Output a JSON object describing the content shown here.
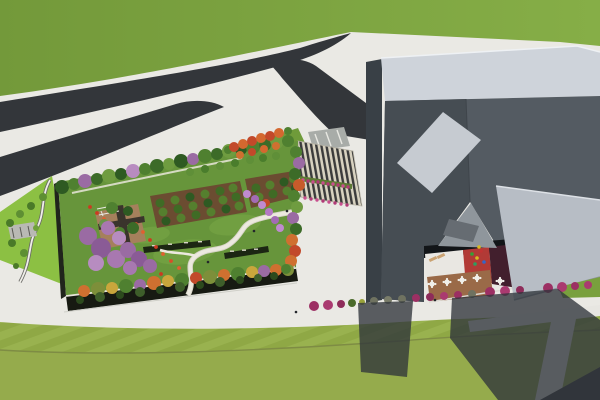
{
  "scene": {
    "alt": "Aerial 3D architectural render: rooftop-garden building and angular gray museum beside forked roads and lawns"
  },
  "palette": {
    "sidewalk": "#eae9e4",
    "grass_a": "#73993a",
    "grass_b": "#86ae47",
    "road": "#33363a",
    "crosswalk": "#a8aca8",
    "park_strip": "#8cc043",
    "pergola_gray": "#b9b9b4",
    "lawn_stripe_a": "#8fa845",
    "lawn_stripe_b": "#99b24f",
    "lawn_lower": "#95ab4c",
    "asphalt": "#37393c",
    "path_pale": "#e7e6e1",
    "garden_lawn": "#67953b",
    "lawn_patch": "#7aa846",
    "bed_brown": "#6b4c31",
    "hedge_dark": "#1c2613",
    "deck_tan": "#a5805c",
    "deck_dark": "#3a342c",
    "facade_dark": "#171a12",
    "facade_side": "#20241c",
    "berm_green": "#6f9b3a",
    "steps_brown": "#7a4a30",
    "canopy_dark": "#202327",
    "plaza_stripe_dark": "#3b3b3b",
    "plaza_stripe_cream": "#d8d2c0",
    "flower_strip_green": "#5c7a33",
    "rim_light": "#ced3da",
    "left_face": "#394046",
    "roof_dark_left": "#464d53",
    "roof_dark_right": "#545b62",
    "skylight_light": "#c6cbd1",
    "underside_face": "#8f969c",
    "skylight_mid": "#666c72",
    "wing_light": "#b7bdc5",
    "court_gap": "#121518",
    "court_white": "#e9e7e2",
    "court_red": "#b23a36",
    "court_maroon": "#421f2d",
    "court_brown": "#9a6a48",
    "table_white": "#f0efe9",
    "lounger_tan": "#caa272",
    "green_strip": "#79a03d",
    "shadow": "#2f353b"
  },
  "trees": {
    "top_row": [
      [
        62,
        187,
        7,
        "#2e5a22"
      ],
      [
        74,
        184,
        6,
        "#4f8030"
      ],
      [
        85,
        181,
        7,
        "#9a6ba3"
      ],
      [
        97,
        179,
        6,
        "#3c6b28"
      ],
      [
        109,
        176,
        7,
        "#6f9c40"
      ],
      [
        121,
        174,
        6,
        "#2e5a22"
      ],
      [
        133,
        171,
        7,
        "#b88cc0"
      ],
      [
        145,
        169,
        6,
        "#4f8030"
      ],
      [
        157,
        166,
        7,
        "#3c6b28"
      ],
      [
        169,
        164,
        6,
        "#6f9c40"
      ],
      [
        181,
        161,
        7,
        "#2e5a22"
      ],
      [
        193,
        159,
        6,
        "#9a6ba3"
      ],
      [
        205,
        156,
        7,
        "#4f8030"
      ],
      [
        217,
        154,
        6,
        "#3c6b28"
      ],
      [
        229,
        151,
        7,
        "#6f9c40"
      ],
      [
        241,
        149,
        6,
        "#2e5a22"
      ],
      [
        253,
        147,
        7,
        "#4f8030"
      ],
      [
        265,
        145,
        6,
        "#3c6b28"
      ],
      [
        277,
        143,
        6,
        "#6f9c40"
      ],
      [
        288,
        141,
        6,
        "#4f8030"
      ]
    ],
    "street_row": [
      [
        190,
        172,
        4,
        "#5f8f38"
      ],
      [
        205,
        169,
        4,
        "#4a7d2c"
      ],
      [
        220,
        166,
        4,
        "#5f8f38"
      ],
      [
        235,
        163,
        4,
        "#4a7d2c"
      ],
      [
        250,
        160,
        4,
        "#5f8f38"
      ],
      [
        263,
        158,
        4,
        "#4a7d2c"
      ],
      [
        276,
        156,
        4,
        "#5f8f38"
      ]
    ],
    "right_col": [
      [
        296,
        152,
        6,
        "#4f8030"
      ],
      [
        299,
        163,
        6,
        "#9a6ba3"
      ],
      [
        295,
        174,
        6,
        "#3c6b28"
      ],
      [
        299,
        185,
        6,
        "#c75b2b"
      ],
      [
        294,
        196,
        6,
        "#4f8030"
      ],
      [
        297,
        207,
        6,
        "#6f9c40"
      ],
      [
        293,
        218,
        6,
        "#9a6ba3"
      ],
      [
        296,
        229,
        6,
        "#3c6b28"
      ],
      [
        292,
        240,
        6,
        "#cf7030"
      ],
      [
        295,
        251,
        6,
        "#c2492a"
      ],
      [
        291,
        261,
        6,
        "#cf7030"
      ],
      [
        288,
        270,
        6,
        "#7d8f3a"
      ]
    ],
    "bottom_row": [
      [
        84,
        291,
        6,
        "#cf7030"
      ],
      [
        98,
        289,
        7,
        "#7d8f3a"
      ],
      [
        112,
        288,
        6,
        "#c9a63c"
      ],
      [
        126,
        286,
        7,
        "#4f8030"
      ],
      [
        140,
        285,
        6,
        "#9a6ba3"
      ],
      [
        154,
        283,
        7,
        "#cf7030"
      ],
      [
        168,
        281,
        6,
        "#c9a63c"
      ],
      [
        182,
        280,
        7,
        "#4f8030"
      ],
      [
        196,
        278,
        6,
        "#c2492a"
      ],
      [
        210,
        277,
        7,
        "#7d8f3a"
      ],
      [
        224,
        275,
        6,
        "#cf7030"
      ],
      [
        238,
        274,
        7,
        "#4f8030"
      ],
      [
        252,
        272,
        6,
        "#c9a63c"
      ],
      [
        264,
        271,
        6,
        "#9a6ba3"
      ],
      [
        276,
        270,
        6,
        "#cf7030"
      ],
      [
        286,
        269,
        5,
        "#4f8030"
      ]
    ],
    "purple_cluster": [
      [
        88,
        236,
        9,
        "#9a6ba3"
      ],
      [
        101,
        248,
        10,
        "#8a5b96"
      ],
      [
        116,
        259,
        9,
        "#a878b0"
      ],
      [
        96,
        263,
        8,
        "#b78cc0"
      ],
      [
        128,
        250,
        8,
        "#9a6ba3"
      ],
      [
        139,
        259,
        8,
        "#8a5b96"
      ],
      [
        119,
        238,
        7,
        "#b78cc0"
      ],
      [
        108,
        228,
        7,
        "#a878b0"
      ],
      [
        150,
        266,
        7,
        "#9a6ba3"
      ],
      [
        130,
        268,
        7,
        "#a878b0"
      ]
    ],
    "blossom_row": [
      [
        247,
        194,
        4,
        "#c08ad0"
      ],
      [
        255,
        199,
        4,
        "#a36bb5"
      ],
      [
        262,
        205,
        4,
        "#c08ad0"
      ],
      [
        269,
        212,
        4,
        "#b478c4"
      ],
      [
        275,
        220,
        4,
        "#a36bb5"
      ],
      [
        280,
        228,
        4,
        "#c08ad0"
      ]
    ],
    "orchard_a": [
      [
        160,
        203,
        4.5,
        "#3f6b25"
      ],
      [
        175,
        200,
        4.5,
        "#557f2e"
      ],
      [
        190,
        197,
        4.5,
        "#2e5a22"
      ],
      [
        205,
        194,
        4.5,
        "#557f2e"
      ],
      [
        220,
        191,
        4.5,
        "#3f6b25"
      ],
      [
        233,
        188,
        4.5,
        "#557f2e"
      ],
      [
        163,
        212,
        4.5,
        "#557f2e"
      ],
      [
        178,
        209,
        4.5,
        "#3f6b25"
      ],
      [
        193,
        206,
        4.5,
        "#557f2e"
      ],
      [
        208,
        203,
        4.5,
        "#2e5a22"
      ],
      [
        223,
        200,
        4.5,
        "#557f2e"
      ],
      [
        236,
        197,
        4.5,
        "#3f6b25"
      ],
      [
        166,
        221,
        4.5,
        "#2e5a22"
      ],
      [
        181,
        218,
        4.5,
        "#557f2e"
      ],
      [
        196,
        215,
        4.5,
        "#3f6b25"
      ],
      [
        211,
        212,
        4.5,
        "#557f2e"
      ],
      [
        226,
        209,
        4.5,
        "#2e5a22"
      ],
      [
        239,
        206,
        4.5,
        "#557f2e"
      ]
    ],
    "orchard_b": [
      [
        256,
        188,
        4.5,
        "#3f6b25"
      ],
      [
        270,
        185,
        4.5,
        "#557f2e"
      ],
      [
        284,
        182,
        4.5,
        "#2e5a22"
      ],
      [
        293,
        179,
        4,
        "#557f2e"
      ],
      [
        259,
        197,
        4.5,
        "#557f2e"
      ],
      [
        273,
        194,
        4.5,
        "#3f6b25"
      ],
      [
        287,
        191,
        4.5,
        "#557f2e"
      ],
      [
        295,
        188,
        4,
        "#2e5a22"
      ],
      [
        266,
        203,
        4,
        "#c2492a"
      ]
    ],
    "deck_trees": [
      [
        112,
        208,
        6,
        "#4f8030"
      ],
      [
        128,
        211,
        5,
        "#2e5a22"
      ],
      [
        104,
        224,
        5,
        "#6a944a"
      ],
      [
        133,
        228,
        6,
        "#3c6b28"
      ],
      [
        120,
        232,
        5,
        "#4f8030"
      ]
    ],
    "berm_trees": [
      [
        228,
        150,
        4,
        "#4f8030"
      ],
      [
        234,
        147,
        5,
        "#c2492a"
      ],
      [
        243,
        144,
        5,
        "#d4682f"
      ],
      [
        252,
        141,
        5,
        "#c2492a"
      ],
      [
        261,
        138,
        5,
        "#d4682f"
      ],
      [
        270,
        136,
        5,
        "#c2492a"
      ],
      [
        279,
        133,
        5,
        "#d4682f"
      ],
      [
        288,
        131,
        4,
        "#4f8030"
      ],
      [
        240,
        155,
        4,
        "#cf7030"
      ],
      [
        252,
        152,
        4,
        "#c2492a"
      ],
      [
        264,
        149,
        4,
        "#d4682f"
      ],
      [
        276,
        146,
        4,
        "#cf7030"
      ]
    ],
    "park_bushes": [
      [
        10,
        223,
        4,
        "#4a7a28"
      ],
      [
        20,
        214,
        4,
        "#5e8f33"
      ],
      [
        31,
        206,
        4,
        "#4a7a28"
      ],
      [
        43,
        197,
        4,
        "#5e8f33"
      ],
      [
        12,
        243,
        4,
        "#4a7a28"
      ],
      [
        24,
        253,
        4,
        "#5e8f33"
      ],
      [
        16,
        266,
        3,
        "#4a7a28"
      ],
      [
        36,
        228,
        3,
        "#6fa03a"
      ]
    ],
    "facade_bushes": [
      [
        80,
        300,
        4,
        "#2c4a1d"
      ],
      [
        100,
        297,
        5,
        "#3e5e2a"
      ],
      [
        120,
        295,
        4,
        "#2c4a1d"
      ],
      [
        140,
        292,
        5,
        "#3e5e2a"
      ],
      [
        160,
        290,
        4,
        "#2c4a1d"
      ],
      [
        180,
        287,
        5,
        "#3e5e2a"
      ],
      [
        200,
        285,
        4,
        "#2c4a1d"
      ],
      [
        220,
        282,
        5,
        "#3e5e2a"
      ],
      [
        240,
        280,
        4,
        "#2c4a1d"
      ],
      [
        258,
        278,
        4,
        "#3e5e2a"
      ],
      [
        274,
        276,
        4,
        "#2c4a1d"
      ]
    ],
    "shrub_row": [
      [
        314,
        306,
        5,
        "#9c2f63"
      ],
      [
        328,
        305,
        5,
        "#aa3a70"
      ],
      [
        341,
        304,
        4,
        "#8e2c5a"
      ],
      [
        352,
        303,
        4,
        "#4a6a2a"
      ],
      [
        362,
        302,
        3,
        "#9aa33a"
      ],
      [
        374,
        301,
        4,
        "#6f7260"
      ],
      [
        388,
        300,
        4,
        "#7a7d6a"
      ],
      [
        402,
        299,
        4,
        "#6f7260"
      ],
      [
        416,
        298,
        4,
        "#9c2f63"
      ],
      [
        430,
        297,
        4,
        "#8e2c5a"
      ],
      [
        444,
        296,
        4,
        "#aa3a70"
      ],
      [
        458,
        295,
        4,
        "#9c2f63"
      ],
      [
        472,
        294,
        4,
        "#6f7260"
      ],
      [
        490,
        292,
        5,
        "#9c2f63"
      ],
      [
        505,
        291,
        5,
        "#aa3a70"
      ],
      [
        520,
        290,
        4,
        "#8e2c5a"
      ],
      [
        548,
        288,
        5,
        "#9c2f63"
      ],
      [
        562,
        287,
        5,
        "#aa3a70"
      ],
      [
        575,
        286,
        4,
        "#9c2f63"
      ],
      [
        588,
        285,
        4,
        "#aa3a70"
      ]
    ]
  },
  "flowers": {
    "red": [
      [
        97,
        213,
        "#cc3a20"
      ],
      [
        104,
        219,
        "#e06030"
      ],
      [
        110,
        226,
        "#d94f28"
      ],
      [
        117,
        233,
        "#cc3a20"
      ],
      [
        124,
        240,
        "#e06030"
      ],
      [
        131,
        247,
        "#d94f28"
      ],
      [
        138,
        254,
        "#cc3a20"
      ],
      [
        146,
        261,
        "#e06030"
      ],
      [
        153,
        268,
        "#d94f28"
      ],
      [
        161,
        274,
        "#cc3a20"
      ],
      [
        169,
        280,
        "#e06030"
      ],
      [
        177,
        286,
        "#d94f28"
      ],
      [
        150,
        240,
        "#cc3a20"
      ],
      [
        143,
        232,
        "#e06030"
      ],
      [
        136,
        224,
        "#d94f28"
      ],
      [
        156,
        247,
        "#cc3a20"
      ],
      [
        163,
        254,
        "#e06030"
      ],
      [
        171,
        261,
        "#d94f28"
      ],
      [
        90,
        207,
        "#cc3a20"
      ],
      [
        179,
        268,
        "#e06030"
      ]
    ],
    "pink_row1": [
      [
        303,
        180,
        "#c94f8e"
      ],
      [
        308,
        181,
        "#b13a77"
      ],
      [
        313,
        182,
        "#c94f8e"
      ],
      [
        318,
        182,
        "#b13a77"
      ],
      [
        323,
        183,
        "#c94f8e"
      ],
      [
        328,
        184,
        "#b13a77"
      ],
      [
        333,
        184,
        "#c94f8e"
      ],
      [
        338,
        185,
        "#b13a77"
      ],
      [
        343,
        186,
        "#c94f8e"
      ],
      [
        348,
        187,
        "#b13a77"
      ]
    ],
    "pink_row2": [
      [
        305,
        198,
        "#c94f8e"
      ],
      [
        311,
        199,
        "#b13a77"
      ],
      [
        317,
        200,
        "#c94f8e"
      ],
      [
        323,
        201,
        "#b13a77"
      ],
      [
        329,
        202,
        "#c94f8e"
      ],
      [
        335,
        203,
        "#b13a77"
      ],
      [
        341,
        204,
        "#c94f8e"
      ],
      [
        347,
        205,
        "#b13a77"
      ]
    ]
  },
  "courtyard": {
    "tables": [
      [
        432,
        284
      ],
      [
        447,
        282
      ],
      [
        462,
        280
      ],
      [
        477,
        278
      ],
      [
        500,
        281
      ]
    ],
    "loungers": [
      [
        433,
        259,
        -25
      ],
      [
        441,
        256,
        -25
      ]
    ],
    "playground": [
      [
        472,
        254,
        "#35a035"
      ],
      [
        477,
        258,
        "#d8b920"
      ],
      [
        481,
        251,
        "#c23333"
      ],
      [
        484,
        262,
        "#3565c9"
      ],
      [
        475,
        264,
        "#2f9e5f"
      ],
      [
        479,
        247,
        "#d8b920"
      ]
    ]
  },
  "people": [
    [
      208,
      262
    ],
    [
      254,
      231
    ],
    [
      287,
      211
    ],
    [
      296,
      312
    ],
    [
      435,
      300
    ]
  ]
}
